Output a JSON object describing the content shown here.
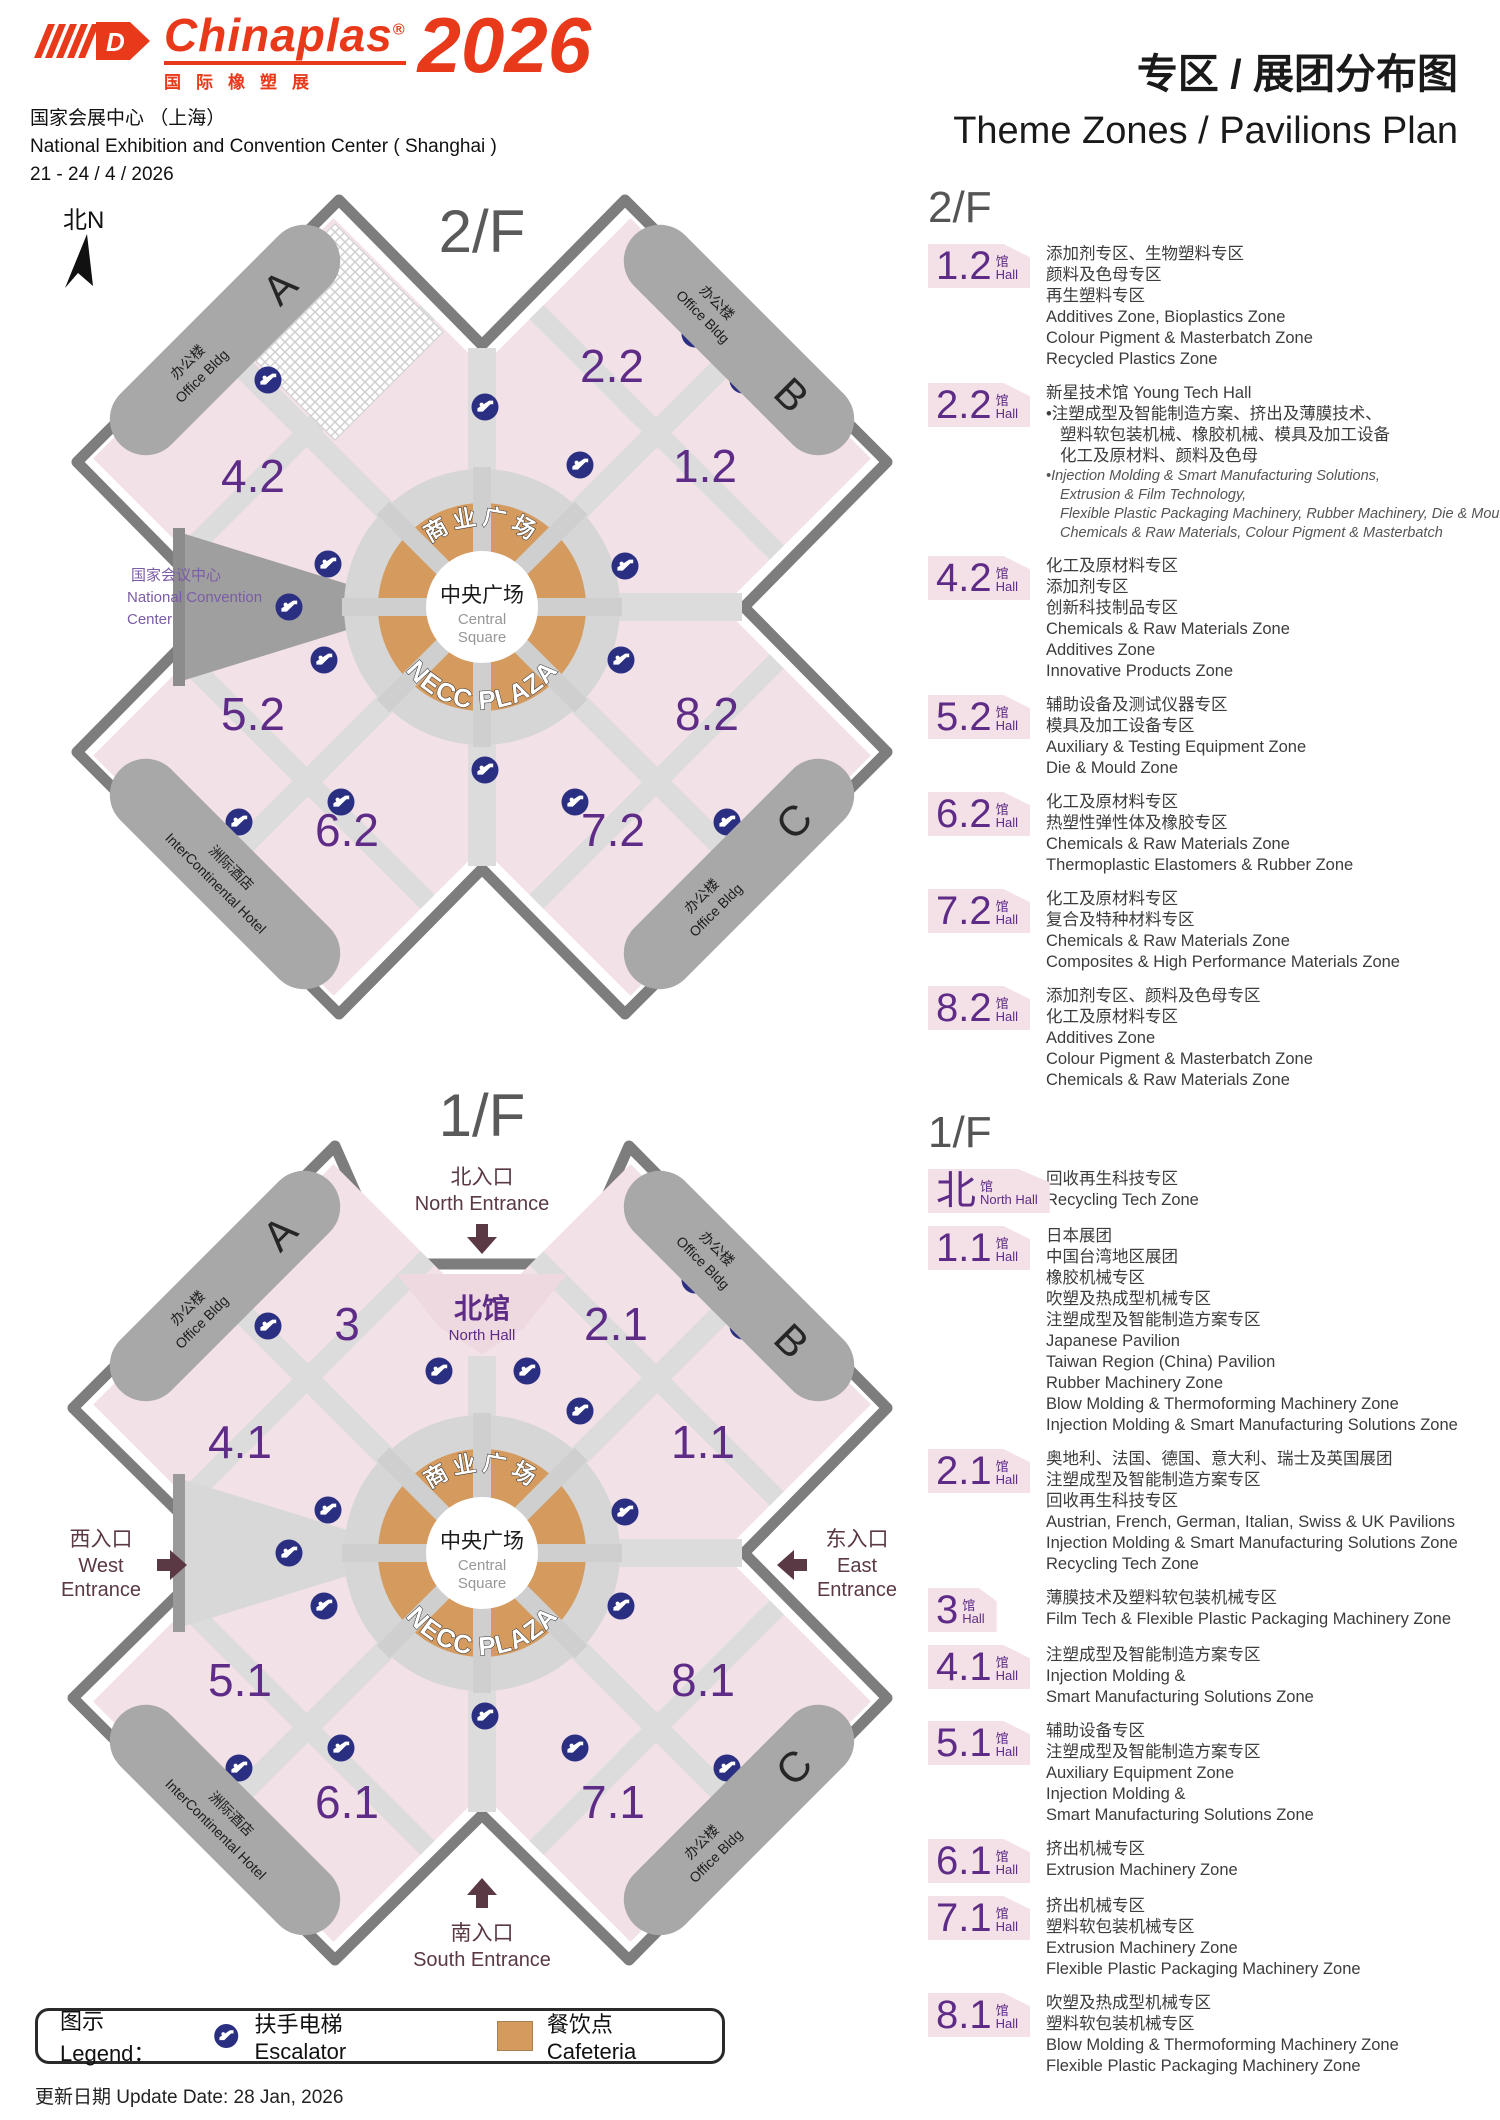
{
  "header": {
    "logo_brand": "Chinaplas",
    "logo_reg": "®",
    "logo_d": "D",
    "logo_cn": "国际橡塑展",
    "logo_year": "2026",
    "venue_cn": "国家会展中心 （上海）",
    "venue_en": "National Exhibition and Convention Center ( Shanghai )",
    "dates": "21 - 24 / 4 / 2026",
    "title_cn": "专区 / 展团分布图",
    "title_en": "Theme Zones / Pavilions Plan"
  },
  "colors": {
    "brand_red": "#e8391b",
    "hall_purple": "#5e2c87",
    "hall_pink": "#f2e1e6",
    "badge_pink": "#f4e0e7",
    "plaza_orange": "#d49a5e",
    "escalator_blue": "#2b2f82",
    "entrance_maroon": "#5a3844",
    "aisle_gray": "#dcdcdc"
  },
  "maps": {
    "floor2": {
      "label": "2/F",
      "compass": "北N",
      "halls": [
        "2.2",
        "1.2",
        "4.2",
        "5.2",
        "8.2",
        "6.2",
        "7.2"
      ],
      "ncc1": "国家会议中心",
      "ncc2": "National Convention",
      "ncc3": "Center",
      "plaza": {
        "arc_cn": "商业广场",
        "arc_en": "NECC PLAZA",
        "c1": "中央广场",
        "c2": "Central",
        "c3": "Square"
      },
      "corners": {
        "office_cn": "办公楼",
        "office_en": "Office Bldg",
        "a": "A",
        "b": "B",
        "c": "C",
        "hotel_cn": "洲际酒店",
        "hotel_en": "InterContinental Hotel"
      }
    },
    "floor1": {
      "label": "1/F",
      "halls": [
        "3",
        "2.1",
        "4.1",
        "1.1",
        "5.1",
        "8.1",
        "6.1",
        "7.1"
      ],
      "north_hall": {
        "cn": "北馆",
        "en": "North Hall"
      },
      "entrances": {
        "north_cn": "北入口",
        "north_en": "North Entrance",
        "west_cn": "西入口",
        "west_en1": "West",
        "west_en2": "Entrance",
        "east_cn": "东入口",
        "east_en1": "East",
        "east_en2": "Entrance",
        "south_cn": "南入口",
        "south_en": "South Entrance"
      },
      "plaza": {
        "arc_cn": "商业广场",
        "arc_en": "NECC PLAZA",
        "c1": "中央广场",
        "c2": "Central",
        "c3": "Square"
      },
      "corners": {
        "office_cn": "办公楼",
        "office_en": "Office Bldg",
        "a": "A",
        "b": "B",
        "c": "C",
        "hotel_cn": "洲际酒店",
        "hotel_en": "InterContinental Hotel"
      }
    }
  },
  "sidebar": {
    "floor2_heading": "2/F",
    "floor1_heading": "1/F",
    "floor2_entries": [
      {
        "hall": "1.2",
        "unit_cn": "馆",
        "unit_en": "Hall",
        "lines": [
          {
            "t": "添加剂专区、生物塑料专区",
            "s": "cn"
          },
          {
            "t": "颜料及色母专区",
            "s": "cn"
          },
          {
            "t": "再生塑料专区",
            "s": "cn"
          },
          {
            "t": "Additives Zone, Bioplastics Zone",
            "s": "en"
          },
          {
            "t": "Colour Pigment & Masterbatch Zone",
            "s": "en"
          },
          {
            "t": "Recycled Plastics Zone",
            "s": "en"
          }
        ]
      },
      {
        "hall": "2.2",
        "unit_cn": "馆",
        "unit_en": "Hall",
        "lines": [
          {
            "t": "新星技术馆 Young Tech Hall",
            "s": "cn"
          },
          {
            "t": "注塑成型及智能制造方案、挤出及薄膜技术、",
            "s": "bc"
          },
          {
            "t": "塑料软包装机械、橡胶机械、模具及加工设备",
            "s": "cc"
          },
          {
            "t": "化工及原材料、颜料及色母",
            "s": "cc"
          },
          {
            "t": "Injection Molding & Smart Manufacturing Solutions,",
            "s": "bi"
          },
          {
            "t": "Extrusion & Film Technology,",
            "s": "ci"
          },
          {
            "t": "Flexible Plastic Packaging Machinery, Rubber Machinery, Die & Mould",
            "s": "ci"
          },
          {
            "t": "Chemicals & Raw Materials, Colour Pigment & Masterbatch",
            "s": "ci"
          }
        ]
      },
      {
        "hall": "4.2",
        "unit_cn": "馆",
        "unit_en": "Hall",
        "lines": [
          {
            "t": "化工及原材料专区",
            "s": "cn"
          },
          {
            "t": "添加剂专区",
            "s": "cn"
          },
          {
            "t": "创新科技制品专区",
            "s": "cn"
          },
          {
            "t": "Chemicals & Raw Materials Zone",
            "s": "en"
          },
          {
            "t": "Additives Zone",
            "s": "en"
          },
          {
            "t": "Innovative Products Zone",
            "s": "en"
          }
        ]
      },
      {
        "hall": "5.2",
        "unit_cn": "馆",
        "unit_en": "Hall",
        "lines": [
          {
            "t": "辅助设备及测试仪器专区",
            "s": "cn"
          },
          {
            "t": "模具及加工设备专区",
            "s": "cn"
          },
          {
            "t": "Auxiliary & Testing Equipment Zone",
            "s": "en"
          },
          {
            "t": "Die & Mould Zone",
            "s": "en"
          }
        ]
      },
      {
        "hall": "6.2",
        "unit_cn": "馆",
        "unit_en": "Hall",
        "lines": [
          {
            "t": "化工及原材料专区",
            "s": "cn"
          },
          {
            "t": "热塑性弹性体及橡胶专区",
            "s": "cn"
          },
          {
            "t": "Chemicals & Raw Materials Zone",
            "s": "en"
          },
          {
            "t": "Thermoplastic Elastomers & Rubber Zone",
            "s": "en"
          }
        ]
      },
      {
        "hall": "7.2",
        "unit_cn": "馆",
        "unit_en": "Hall",
        "lines": [
          {
            "t": "化工及原材料专区",
            "s": "cn"
          },
          {
            "t": "复合及特种材料专区",
            "s": "cn"
          },
          {
            "t": "Chemicals & Raw Materials Zone",
            "s": "en"
          },
          {
            "t": "Composites & High Performance Materials Zone",
            "s": "en"
          }
        ]
      },
      {
        "hall": "8.2",
        "unit_cn": "馆",
        "unit_en": "Hall",
        "lines": [
          {
            "t": "添加剂专区、颜料及色母专区",
            "s": "cn"
          },
          {
            "t": "化工及原材料专区",
            "s": "cn"
          },
          {
            "t": "Additives Zone",
            "s": "en"
          },
          {
            "t": "Colour Pigment & Masterbatch Zone",
            "s": "en"
          },
          {
            "t": "Chemicals & Raw Materials Zone",
            "s": "en"
          }
        ]
      }
    ],
    "floor1_entries": [
      {
        "hall": "北",
        "unit_cn": "馆",
        "unit_en": "North Hall",
        "lines": [
          {
            "t": "回收再生科技专区",
            "s": "cn"
          },
          {
            "t": "Recycling Tech Zone",
            "s": "en"
          }
        ]
      },
      {
        "hall": "1.1",
        "unit_cn": "馆",
        "unit_en": "Hall",
        "lines": [
          {
            "t": "日本展团",
            "s": "cn"
          },
          {
            "t": "中国台湾地区展团",
            "s": "cn"
          },
          {
            "t": "橡胶机械专区",
            "s": "cn"
          },
          {
            "t": "吹塑及热成型机械专区",
            "s": "cn"
          },
          {
            "t": "注塑成型及智能制造方案专区",
            "s": "cn"
          },
          {
            "t": "Japanese Pavilion",
            "s": "en"
          },
          {
            "t": "Taiwan Region (China) Pavilion",
            "s": "en"
          },
          {
            "t": "Rubber Machinery Zone",
            "s": "en"
          },
          {
            "t": "Blow Molding & Thermoforming Machinery Zone",
            "s": "en"
          },
          {
            "t": "Injection Molding & Smart Manufacturing Solutions Zone",
            "s": "en"
          }
        ]
      },
      {
        "hall": "2.1",
        "unit_cn": "馆",
        "unit_en": "Hall",
        "lines": [
          {
            "t": "奥地利、法国、德国、意大利、瑞士及英国展团",
            "s": "cn"
          },
          {
            "t": "注塑成型及智能制造方案专区",
            "s": "cn"
          },
          {
            "t": "回收再生科技专区",
            "s": "cn"
          },
          {
            "t": "Austrian, French, German, Italian, Swiss & UK Pavilions",
            "s": "en"
          },
          {
            "t": "Injection Molding & Smart Manufacturing Solutions Zone",
            "s": "en"
          },
          {
            "t": "Recycling Tech Zone",
            "s": "en"
          }
        ]
      },
      {
        "hall": "3",
        "unit_cn": "馆",
        "unit_en": "Hall",
        "lines": [
          {
            "t": "薄膜技术及塑料软包装机械专区",
            "s": "cn"
          },
          {
            "t": "Film Tech & Flexible Plastic Packaging Machinery Zone",
            "s": "en"
          }
        ]
      },
      {
        "hall": "4.1",
        "unit_cn": "馆",
        "unit_en": "Hall",
        "lines": [
          {
            "t": "注塑成型及智能制造方案专区",
            "s": "cn"
          },
          {
            "t": "Injection Molding &",
            "s": "en"
          },
          {
            "t": "Smart Manufacturing Solutions Zone",
            "s": "en"
          }
        ]
      },
      {
        "hall": "5.1",
        "unit_cn": "馆",
        "unit_en": "Hall",
        "lines": [
          {
            "t": "辅助设备专区",
            "s": "cn"
          },
          {
            "t": "注塑成型及智能制造方案专区",
            "s": "cn"
          },
          {
            "t": "Auxiliary Equipment Zone",
            "s": "en"
          },
          {
            "t": "Injection Molding &",
            "s": "en"
          },
          {
            "t": "Smart Manufacturing Solutions Zone",
            "s": "en"
          }
        ]
      },
      {
        "hall": "6.1",
        "unit_cn": "馆",
        "unit_en": "Hall",
        "lines": [
          {
            "t": "挤出机械专区",
            "s": "cn"
          },
          {
            "t": "Extrusion Machinery Zone",
            "s": "en"
          }
        ]
      },
      {
        "hall": "7.1",
        "unit_cn": "馆",
        "unit_en": "Hall",
        "lines": [
          {
            "t": "挤出机械专区",
            "s": "cn"
          },
          {
            "t": "塑料软包装机械专区",
            "s": "cn"
          },
          {
            "t": "Extrusion Machinery Zone",
            "s": "en"
          },
          {
            "t": "Flexible Plastic Packaging Machinery Zone",
            "s": "en"
          }
        ]
      },
      {
        "hall": "8.1",
        "unit_cn": "馆",
        "unit_en": "Hall",
        "lines": [
          {
            "t": "吹塑及热成型机械专区",
            "s": "cn"
          },
          {
            "t": "塑料软包装机械专区",
            "s": "cn"
          },
          {
            "t": "Blow Molding & Thermoforming Machinery Zone",
            "s": "en"
          },
          {
            "t": "Flexible Plastic Packaging Machinery Zone",
            "s": "en"
          }
        ]
      }
    ]
  },
  "legend": {
    "label": "图示 Legend：",
    "escalator": "扶手电梯 Escalator",
    "cafeteria": "餐饮点 Cafeteria"
  },
  "footer": {
    "update": "更新日期 Update Date: 28 Jan, 2026"
  }
}
